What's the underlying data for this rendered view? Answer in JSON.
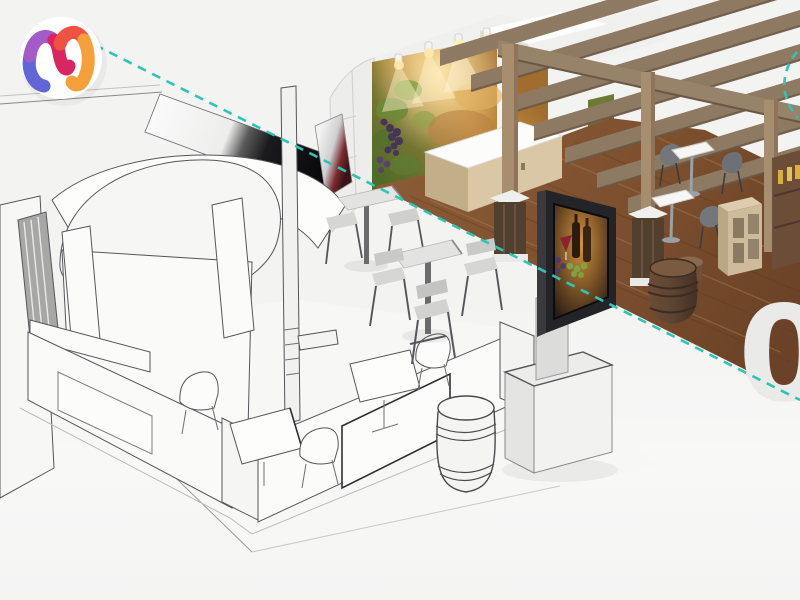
{
  "page": {
    "background": "#f3f3f2"
  },
  "brand_logo": {
    "name": "m-monogram-logo",
    "colors": {
      "purple": "#a35bc7",
      "magenta": "#d92562",
      "coral": "#ef5243",
      "orange": "#f6a03c",
      "indigo": "#6165d6"
    }
  },
  "divider": {
    "style": "dashed",
    "color": "#2ec4b6"
  },
  "watermark": {
    "text": "01",
    "color": "#eaeae8"
  },
  "scene": {
    "subject": "exhibition-booth-3d-visualization-split-view",
    "left_half": {
      "style": "wireframe-sketch",
      "line_color": "#55565a",
      "surface": "#fbfbfa"
    },
    "right_half": {
      "style": "color-render",
      "pergola_wood": "#8e7a63",
      "floor_wood": "#7c5130",
      "barrel_wood": "#5d4433",
      "mural_green": "#6f7f3a",
      "mural_gold": "#c9943f",
      "screen_frame": "#222428"
    }
  }
}
